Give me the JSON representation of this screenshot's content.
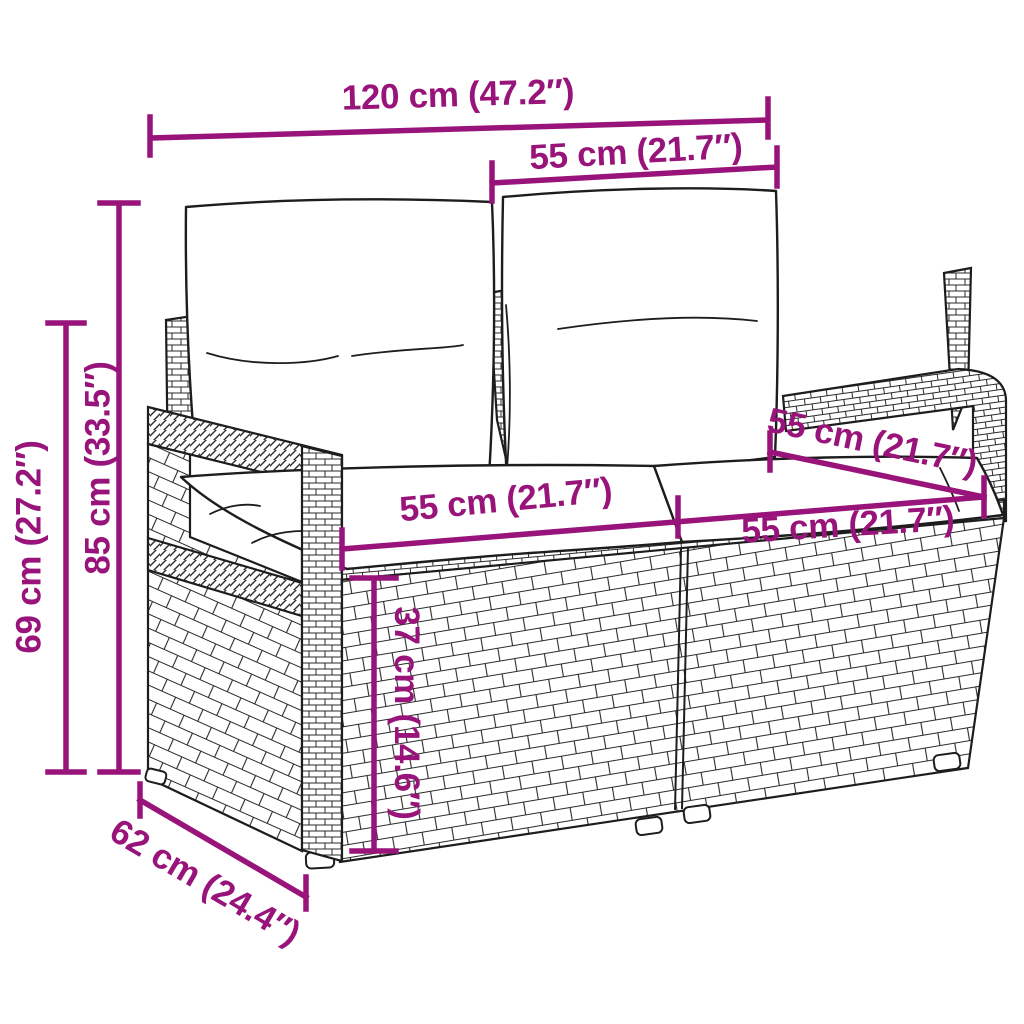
{
  "diagram": {
    "product": "Rattan garden loveseat with cushions — dimension drawing",
    "accent_color": "#98147a",
    "line_color": "#1d1d1d",
    "background_color": "#ffffff",
    "dimensions": [
      {
        "id": "overall-width",
        "label": "120 cm (47.2″)"
      },
      {
        "id": "backrest-cushion-width",
        "label": "55 cm (21.7″)"
      },
      {
        "id": "overall-height",
        "label": "85 cm (33.5″)"
      },
      {
        "id": "frame-height",
        "label": "69 cm (27.2″)"
      },
      {
        "id": "seat-width-left",
        "label": "55 cm (21.7″)"
      },
      {
        "id": "seat-depth",
        "label": "55 cm (21.7″)"
      },
      {
        "id": "seat-width-right",
        "label": "55 cm (21.7″)"
      },
      {
        "id": "seat-height",
        "label": "37 cm (14.6″)"
      },
      {
        "id": "overall-depth",
        "label": "62 cm (24.4″)"
      }
    ]
  }
}
